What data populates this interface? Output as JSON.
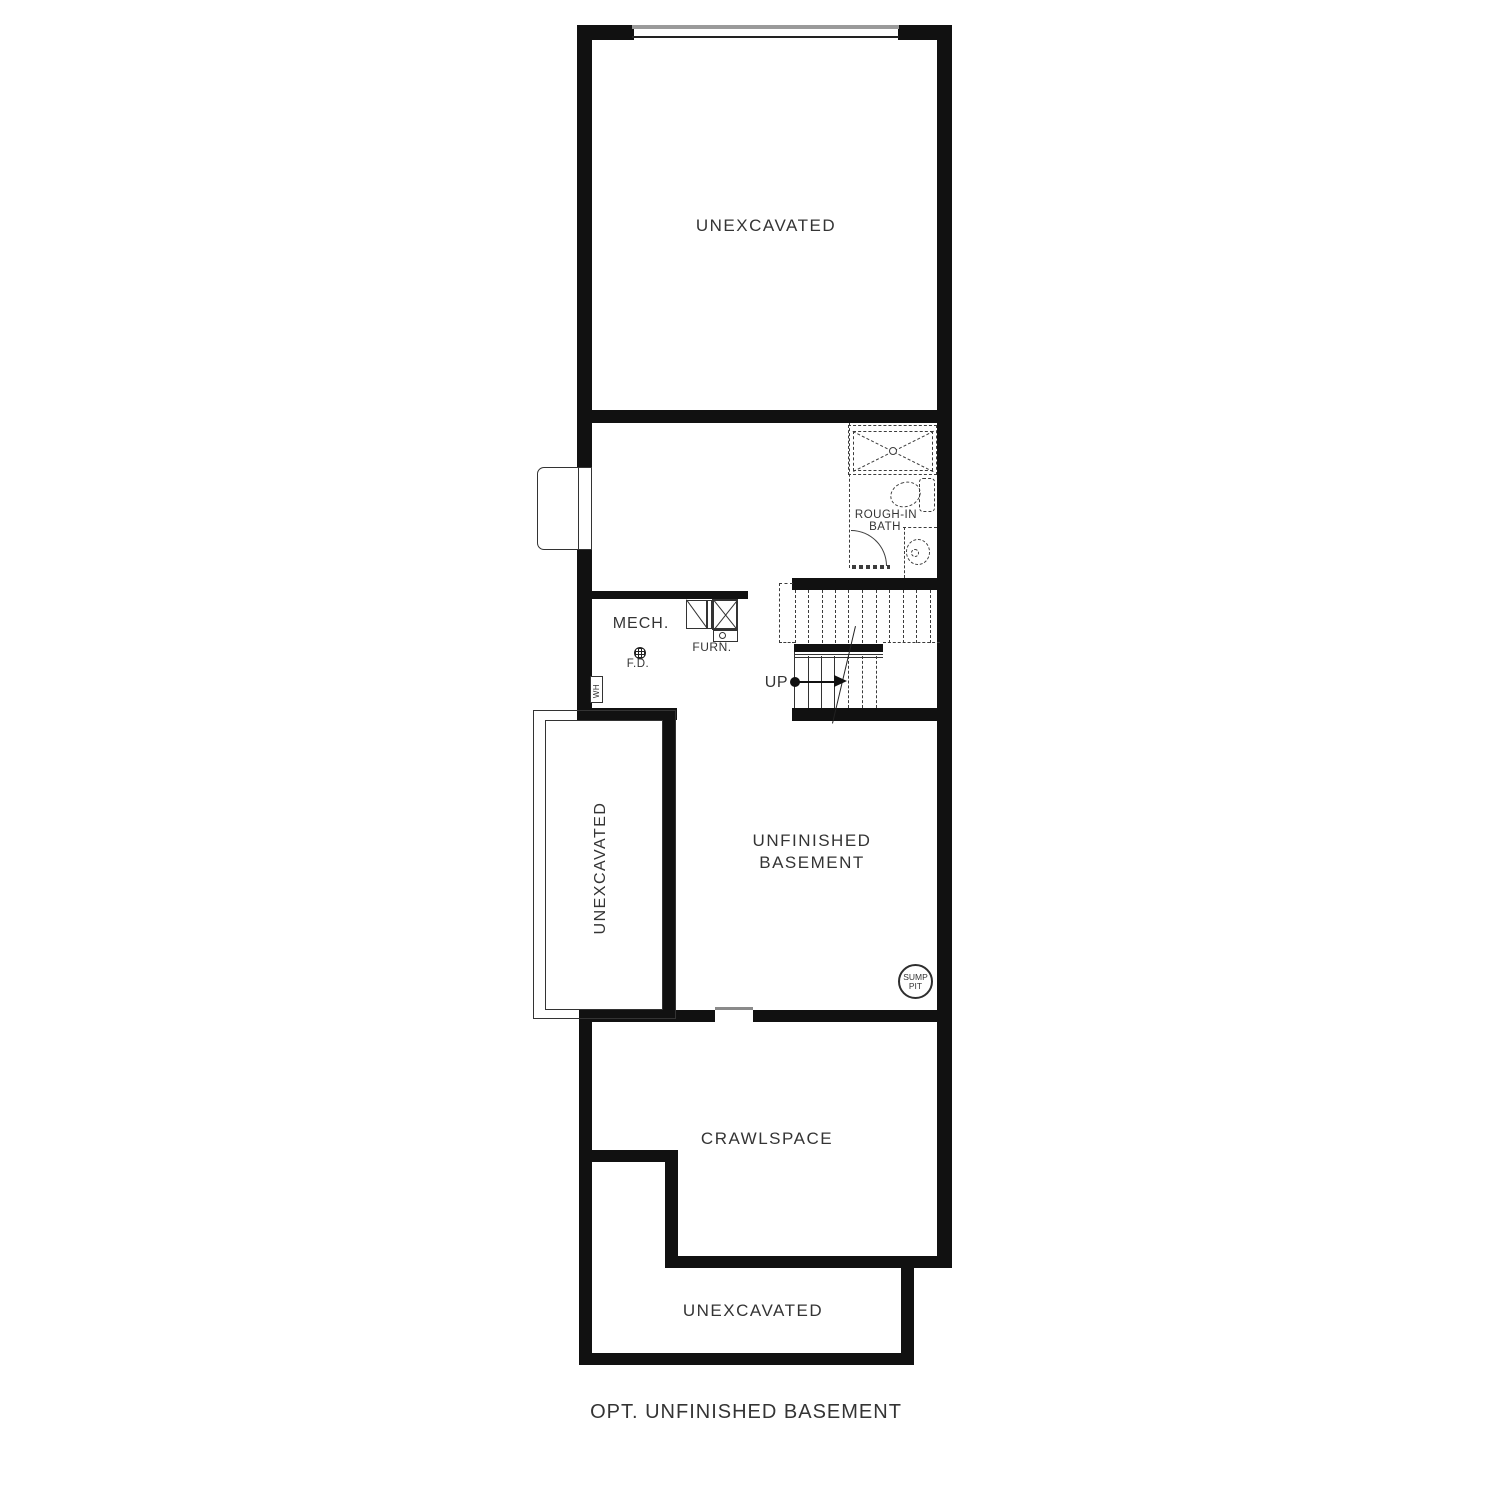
{
  "caption": "OPT. UNFINISHED BASEMENT",
  "rooms": {
    "unexcavated_top": "UNEXCAVATED",
    "unexcavated_left": "UNEXCAVATED",
    "unfinished_basement": [
      "UNFINISHED",
      "BASEMENT"
    ],
    "crawlspace": "CRAWLSPACE",
    "unexcavated_bottom": "UNEXCAVATED"
  },
  "annotations": {
    "mech": "MECH.",
    "floor_drain": "F.D.",
    "furnace": "FURN.",
    "water_heater": "WH",
    "stairs_up": "UP",
    "rough_in_bath": [
      "ROUGH-IN",
      "BATH"
    ],
    "sump_pit": [
      "SUMP",
      "PIT"
    ]
  },
  "colors": {
    "wall": "#111111",
    "line": "#3c3c3c",
    "text": "#343434",
    "background": "#ffffff"
  }
}
